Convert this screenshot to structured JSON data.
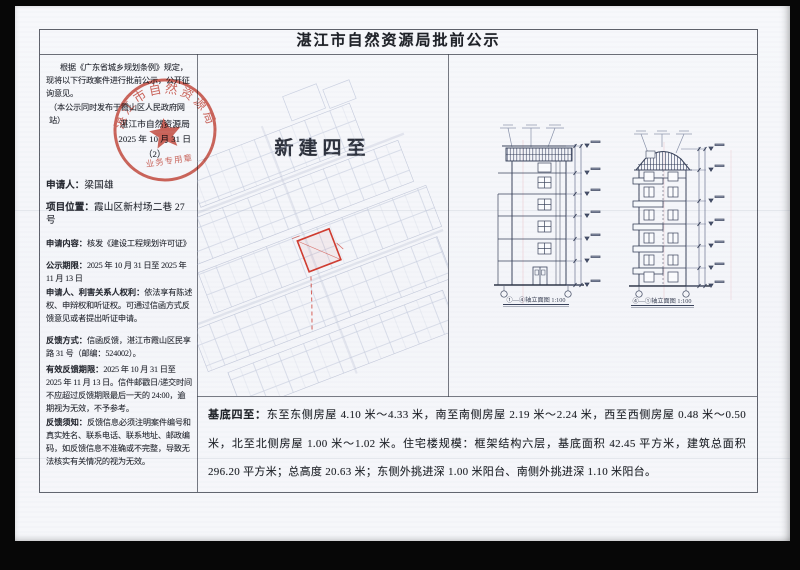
{
  "page": {
    "title": "湛江市自然资源局批前公示"
  },
  "left_panel": {
    "intro": "根据《广东省城乡规划条例》规定，现将以下行政案件进行批前公示，公开征询意见。",
    "intro2": "（本公示同时发布于霞山区人民政府网站）",
    "issuer": "湛江市自然资源局",
    "issue_date": "2025 年 10 月 31 日",
    "issue_no": "（2）",
    "seal": {
      "ring_text": "湛江市自然资源局",
      "bottom_text": "业务专用章"
    },
    "fields": [
      {
        "label": "申请人：",
        "value": "梁国雄"
      },
      {
        "label": "项目位置：",
        "value": "霞山区新村场二巷 27 号"
      },
      {
        "label": "申请内容：",
        "value": "核发《建设工程规划许可证》"
      },
      {
        "label": "公示期限：",
        "value": "2025 年 10 月 31 日至 2025 年 11 月 13 日"
      },
      {
        "label": "申请人、利害关系人权利：",
        "value": "依法享有陈述权、申辩权和听证权。可通过信函方式反馈意见或者提出听证申请。"
      },
      {
        "label": "反馈方式：",
        "value": "信函反馈，湛江市霞山区民享路 31 号（邮编：524002）。"
      },
      {
        "label": "有效反馈期限：",
        "value": "2025 年 10 月 31 日至 2025 年 11 月 13 日。信件邮戳日/递交时间不应超过反馈期限最后一天的 24:00，逾期视为无效，不予参考。"
      },
      {
        "label": "反馈须知：",
        "value": "反馈信息必须注明案件编号和真实姓名、联系电话、联系地址、邮政编码，如反馈信息不准确或不完整，导致无法核实有关情况的视为无效。"
      }
    ]
  },
  "map_panel": {
    "title": "新建四至"
  },
  "elevations": {
    "caption_left": "①—④轴立面图 1:100",
    "caption_right": "④—①轴立面图 1:100"
  },
  "footer": {
    "label": "基底四至：",
    "text": "东至东侧房屋 4.10 米～4.33 米，南至南侧房屋 2.19 米～2.24 米，西至西侧房屋 0.48 米～0.50 米，北至北侧房屋 1.00 米～1.02 米。住宅楼规模：框架结构六层，基底面积 42.45 平方米，建筑总面积 296.20 平方米；总高度 20.63 米；东侧外挑进深 1.00 米阳台、南侧外挑进深 1.10 米阳台。"
  },
  "colors": {
    "seal_red": "#c43a2c",
    "plot_red": "#cf3a2e",
    "ink": "#23262e",
    "drawing_ink": "#39425a",
    "map_line": "#a9b3cd",
    "paper": "#f6f7fa"
  }
}
